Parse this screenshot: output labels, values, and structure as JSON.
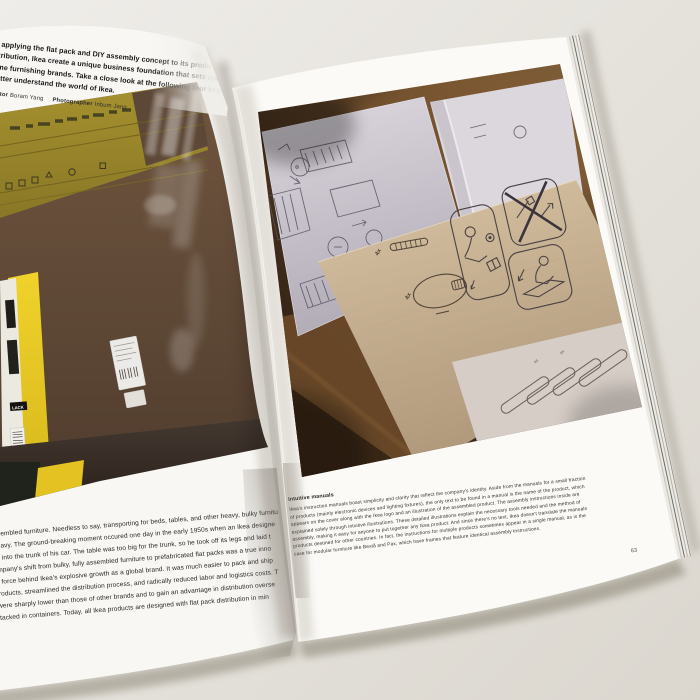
{
  "page": {
    "left": {
      "intro_lines": [
        "y applying the flat pack and DIY assembly concept to its produ",
        "stribution, Ikea create a unique business foundation that sets apar",
        "ome furnishing brands. Take a close look at the following four key",
        "better understand the world of Ikea."
      ],
      "credits": {
        "editor_label": "Editor",
        "editor_name": "Boram Yang",
        "photographer_label": "Photographer",
        "photographer_name": "Inbum Jang"
      },
      "body_lines": [
        "d fully assembled furniture. Needless to say, transporting for beds, tables, and other heavy, bulky furnitu",
        "te cost heavy. The ground-breaking moment occured one day in the early 1950s when an Ikea designe",
        "th a table into the trunk of his car. The table was too big for the trunk, so he took off its legs and laid t",
        ". The company's shift from bulky, fully assembled furniture to prefabricated flat packs was a true inno",
        "a driving force behind Ikea's explosive growth as a global brand. It was much easier to pack and ship",
        "mbled products, streamlined the distribution process, and radically reduced labor and logistics costs. T",
        "es that were sharply lower than those of other brands and to gain an advantage in distribution overse",
        "neatly stacked in containers. Today, all Ikea products are designed with flat pack distribution in min"
      ],
      "photo": {
        "box_label": "LACK"
      }
    },
    "right": {
      "caption_title": "Intuitive manuals",
      "caption_lines": [
        "Ikea's instruction manuals boast simplicity and clarity that reflect the company's identity. Aside from the manuals for a small fraction",
        "of products (mainly electronic devices and lighting fixtures), the only text to be found in a manual is the name of the product, which",
        "appears on the cover along with the Ikea logo and an illustration of the assembled product. The assembly instructions inside are",
        "explained solely through intuitive illustrations. These detailed illustrations explain the necessary tools needed and the method of",
        "assembly, making it easy for anyone to put together any Ikea product. And since there's no text, Ikea doesn't translate the manuals",
        "products destined for other countries. In fact, the instructions for multiple products sometimes appear in a single manual, as is the",
        "case for modular furniture like Bestå and Pax, which have frames that feature identical assembly instructions."
      ],
      "page_number": "63",
      "photo": {
        "qty_screw": "4x",
        "qty_ring": "4x",
        "qty_slats": "4x"
      }
    },
    "colors": {
      "desk": "#e9e6e1",
      "paper": "#f9f8f5",
      "cardboard_brown": "#5d4737",
      "cardboard_olive": "#9a8830",
      "box_yellow": "#e8ca25",
      "table_wood": "#5b3f26",
      "manual_sheet": "#d8d3da",
      "kraft_sheet": "#c8b393",
      "floor_dark": "#352b23"
    }
  }
}
